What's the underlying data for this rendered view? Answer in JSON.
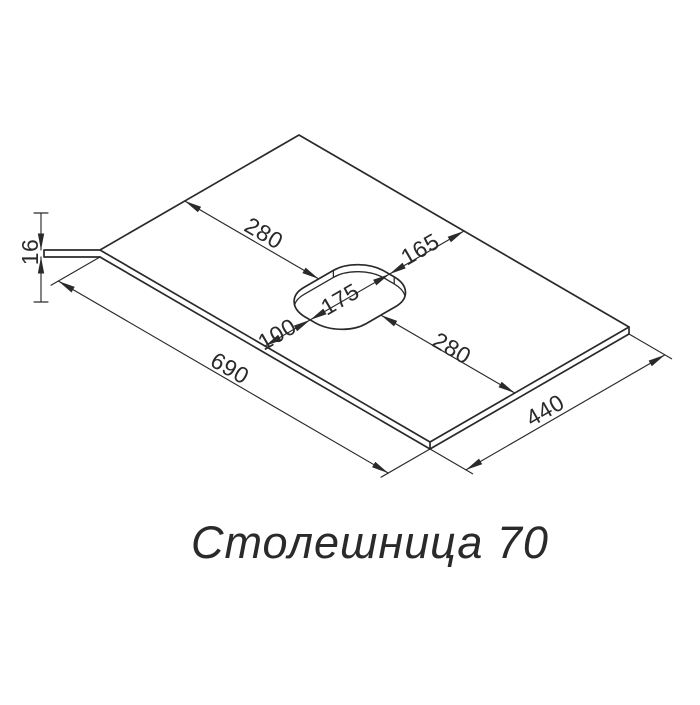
{
  "title": "Столешница 70",
  "dimensions": {
    "length": "690",
    "depth": "440",
    "thickness": "16",
    "hole_offset_left": "280",
    "hole_offset_right": "280",
    "hole_to_back_edge": "165",
    "hole_depth": "175",
    "hole_to_front_edge": "100"
  },
  "colors": {
    "line": "#2a2a2a",
    "background": "#ffffff"
  }
}
